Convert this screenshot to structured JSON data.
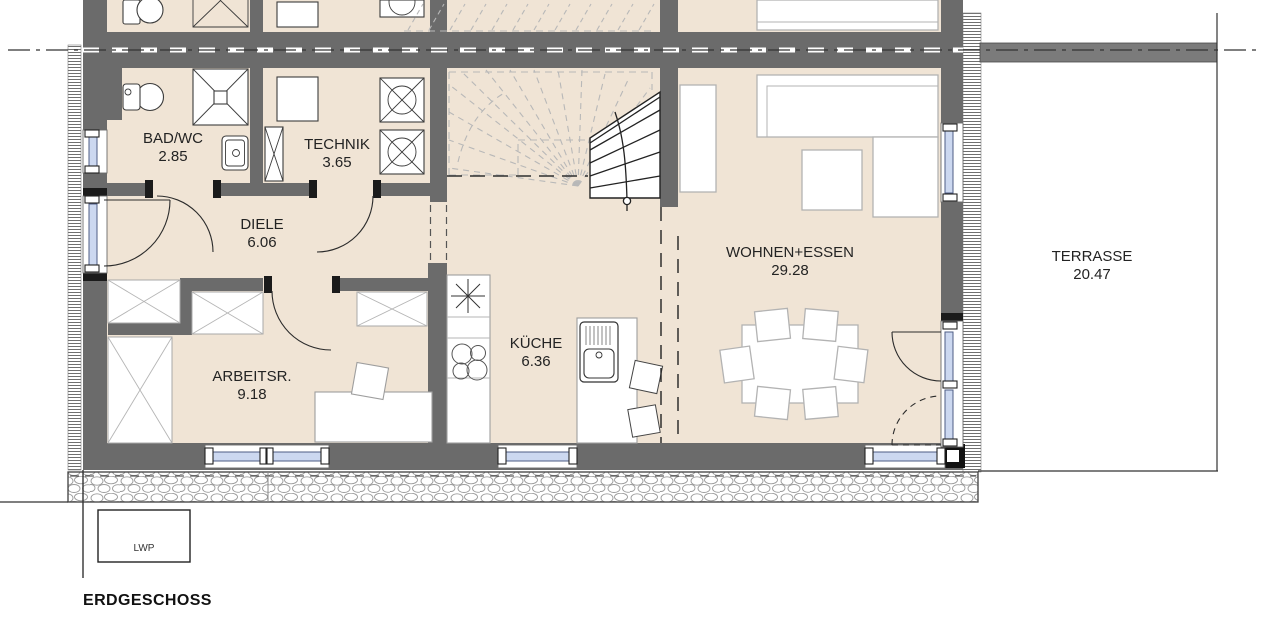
{
  "plan": {
    "floor_title": "ERDGESCHOSS",
    "rooms": [
      {
        "id": "bad",
        "name": "BAD/WC",
        "area": "2.85"
      },
      {
        "id": "technik",
        "name": "TECHNIK",
        "area": "3.65"
      },
      {
        "id": "diele",
        "name": "DIELE",
        "area": "6.06"
      },
      {
        "id": "arbeitsr",
        "name": "ARBEITSR.",
        "area": "9.18"
      },
      {
        "id": "kueche",
        "name": "KÜCHE",
        "area": "6.36"
      },
      {
        "id": "wohnen",
        "name": "WOHNEN+ESSEN",
        "area": "29.28"
      },
      {
        "id": "terrasse",
        "name": "TERRASSE",
        "area": "20.47"
      }
    ],
    "annotations": {
      "heat_pump_label": "LWP"
    },
    "colors": {
      "floor": "#f0e4d5",
      "wall": "#6b6b6b",
      "glazing": "#ccd8f0",
      "glazing_border": "#4e5d85",
      "paper": "#ffffff"
    }
  }
}
